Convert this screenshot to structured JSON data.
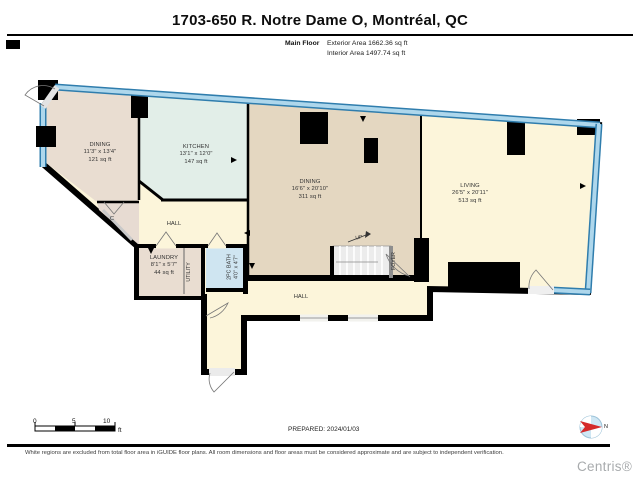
{
  "header": {
    "title": "1703-650 R. Notre Dame O, Montréal, QC",
    "floor_label": "Main Floor",
    "exterior_area": "Exterior Area 1662.36 sq ft",
    "interior_area": "Interior Area 1497.74 sq ft"
  },
  "floor_plan": {
    "rooms": [
      {
        "name": "DINING",
        "dims": "11'3\" x 13'4\"",
        "area": "121 sq ft"
      },
      {
        "name": "KITCHEN",
        "dims": "13'1\" x 12'0\"",
        "area": "147 sq ft"
      },
      {
        "name": "DINING",
        "dims": "16'6\" x 20'10\"",
        "area": "311 sq ft"
      },
      {
        "name": "LIVING",
        "dims": "26'5\" x 20'11\"",
        "area": "513 sq ft"
      },
      {
        "name": "LAUNDRY",
        "dims": "8'1\" x 5'7\"",
        "area": "44 sq ft"
      },
      {
        "name": "2PC BATH",
        "dims": "4'0\" x 4'7\"",
        "area": ""
      }
    ],
    "labels": {
      "hall_upper": "HALL",
      "hall_lower": "HALL",
      "closet": "C",
      "utility": "UTILITY",
      "up": "UP",
      "foyer": "FOYER"
    }
  },
  "footer": {
    "scale": {
      "tick0": "0",
      "tick5": "5",
      "tick10": "10",
      "unit": "ft"
    },
    "prepared": "PREPARED: 2024/01/03",
    "compass_north": "N",
    "disclaimer": "White regions are excluded from total floor area in iGUIDE floor plans. All room dimensions and floor areas must be considered approximate and are subject to independent verification.",
    "brand": "Centris®"
  },
  "colors": {
    "window_blue_light": "#aed7ec",
    "window_blue_dark": "#2f7dad",
    "bath_blue": "#cfe5f1",
    "kitchen_mint": "#e2eee8",
    "dining_tan": "#e4d7c1",
    "dining_beige": "#e9ddd1",
    "living_cream": "#fcf5da",
    "wall_black": "#000000",
    "compass_red": "#d42a2a",
    "brand_gray": "#a8abad"
  }
}
